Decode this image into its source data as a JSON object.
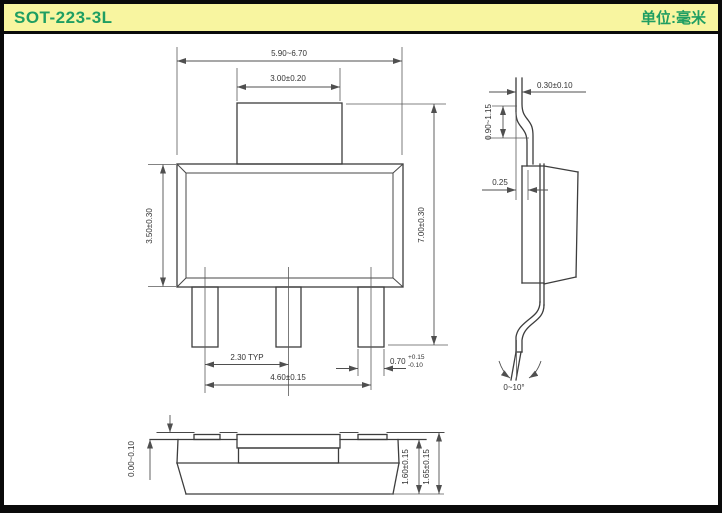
{
  "header": {
    "title": "SOT-223-3L",
    "unit_label": "单位:毫米"
  },
  "colors": {
    "header_bg": "#F8F5A0",
    "header_text": "#1F9E62",
    "line": "#3d3d3d",
    "dim_text": "#333333"
  },
  "dims": {
    "top": {
      "overall_width": "5.90~6.70",
      "tab_width": "3.00±0.20",
      "body_height": "3.50±0.30",
      "total_height": "7.00±0.30",
      "lead_pitch": "2.30 TYP",
      "lead_span": "4.60±0.15",
      "lead_width": "0.70",
      "lead_width_tol_plus": "+0.15",
      "lead_width_tol_minus": "-0.10"
    },
    "side": {
      "lead_thickness": "0.30±0.10",
      "tab_lead_length": "0.90~1.15",
      "lead_offset": "0.25",
      "foot_angle": "0~10°"
    },
    "front": {
      "standoff": "0.00~0.10",
      "body_height": "1.60±0.15",
      "total_height": "1.65±0.15"
    }
  }
}
